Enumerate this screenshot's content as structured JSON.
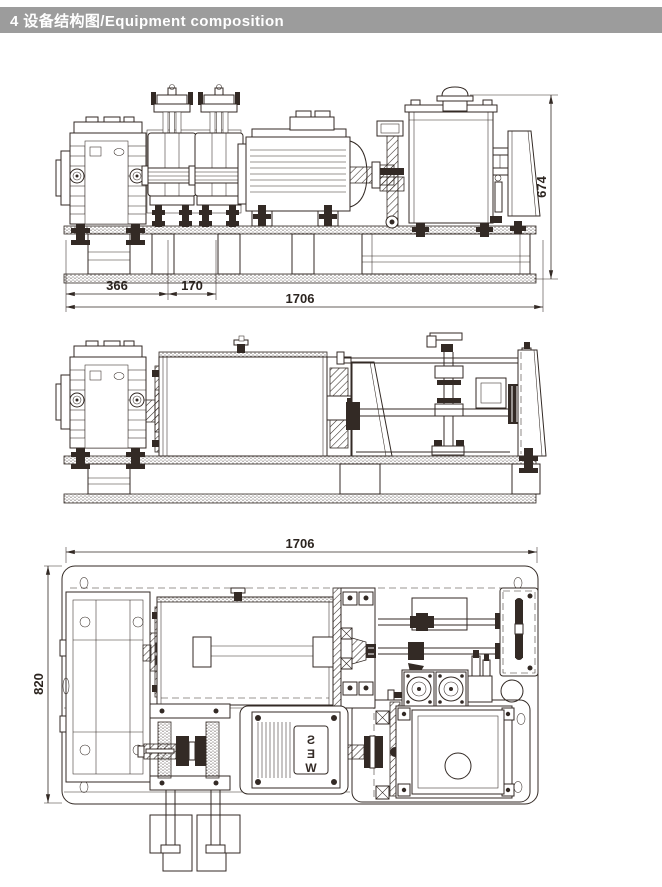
{
  "header": {
    "text": "4  设备结构图/Equipment composition",
    "bg_color": "#9c9c9c",
    "text_color": "#ffffff"
  },
  "drawing": {
    "ink_color": "#332a25",
    "dimensions": {
      "front_left_width": "366",
      "front_mid_width": "170",
      "front_total_length": "1706",
      "front_height": "674",
      "plan_total_length": "1706",
      "plan_depth": "820"
    },
    "motor_logo_letters": [
      "S",
      "E",
      "W"
    ]
  }
}
